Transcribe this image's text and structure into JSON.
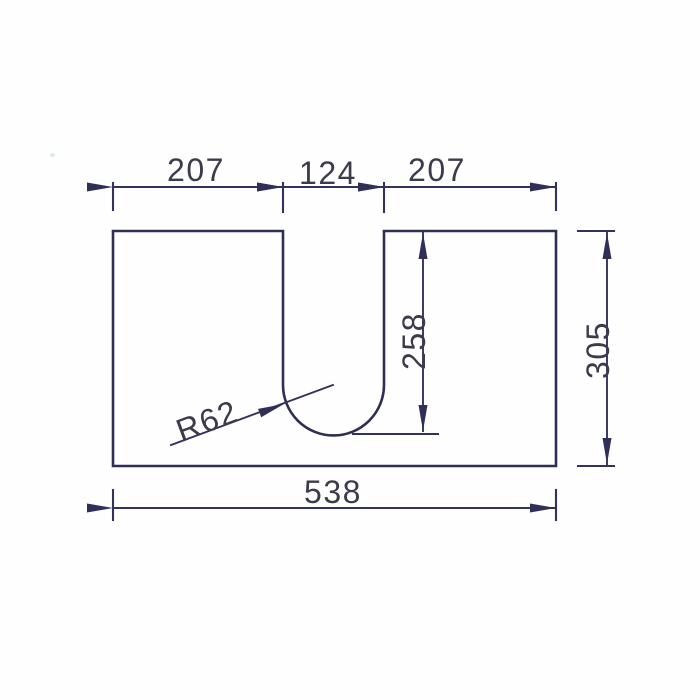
{
  "drawing": {
    "dimensions": {
      "top_left_width": "207",
      "top_slot_width": "124",
      "top_right_width": "207",
      "total_width": "538",
      "total_height": "305",
      "slot_depth": "258",
      "slot_radius": "R62"
    }
  }
}
